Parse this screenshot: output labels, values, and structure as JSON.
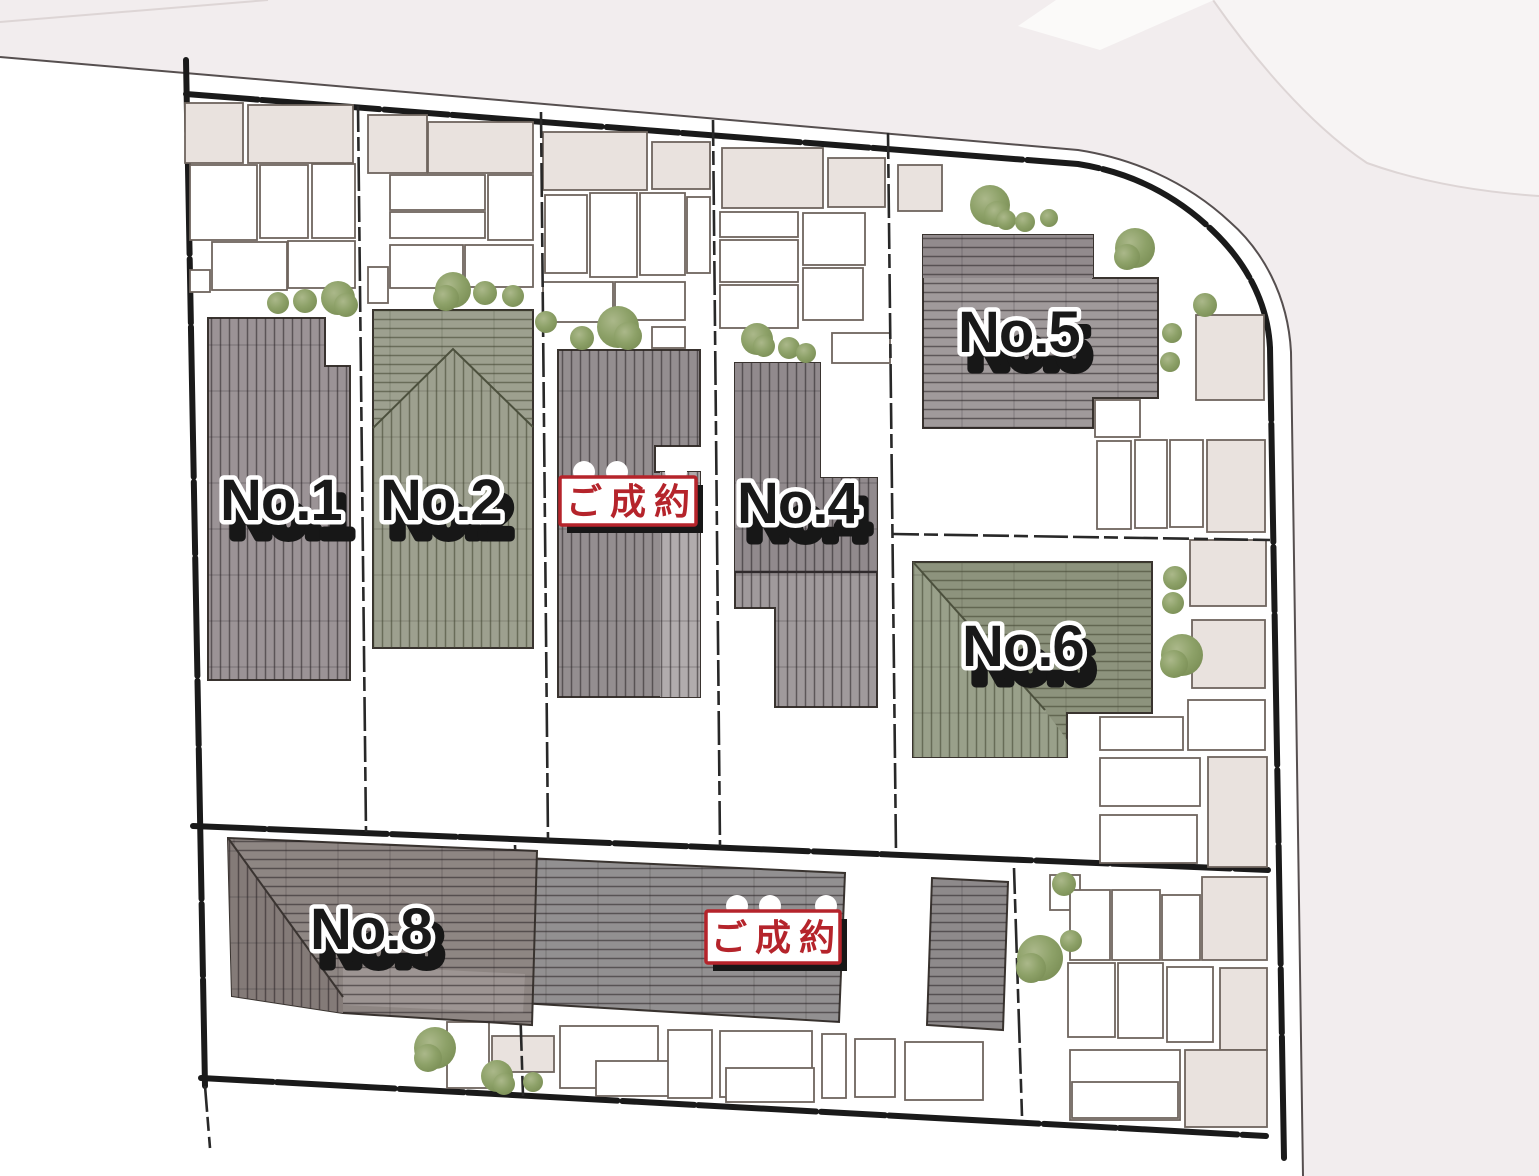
{
  "plan": {
    "type": "residential-site-plan",
    "lots": [
      {
        "id": 1,
        "label": "No.1",
        "status": "available"
      },
      {
        "id": 2,
        "label": "No.2",
        "status": "available"
      },
      {
        "id": 3,
        "label": "",
        "status": "sold"
      },
      {
        "id": 4,
        "label": "No.4",
        "status": "available"
      },
      {
        "id": 5,
        "label": "No.5",
        "status": "available"
      },
      {
        "id": 6,
        "label": "No.6",
        "status": "available"
      },
      {
        "id": 7,
        "label": "",
        "status": "sold"
      },
      {
        "id": 8,
        "label": "No.8",
        "status": "available"
      }
    ],
    "sold_badge_text": "ご成約"
  },
  "palette": {
    "road": "#f2edee",
    "road_light": "#f7f4f4",
    "boundary": "#1a1a1a",
    "roof_gray": "#9b9396",
    "roof_green": "#9da08f",
    "roof_taupe": "#8e8683",
    "parcel_beige": "#e9e2de",
    "tree_green": "#8da168",
    "sold_red": "#b5242b"
  }
}
